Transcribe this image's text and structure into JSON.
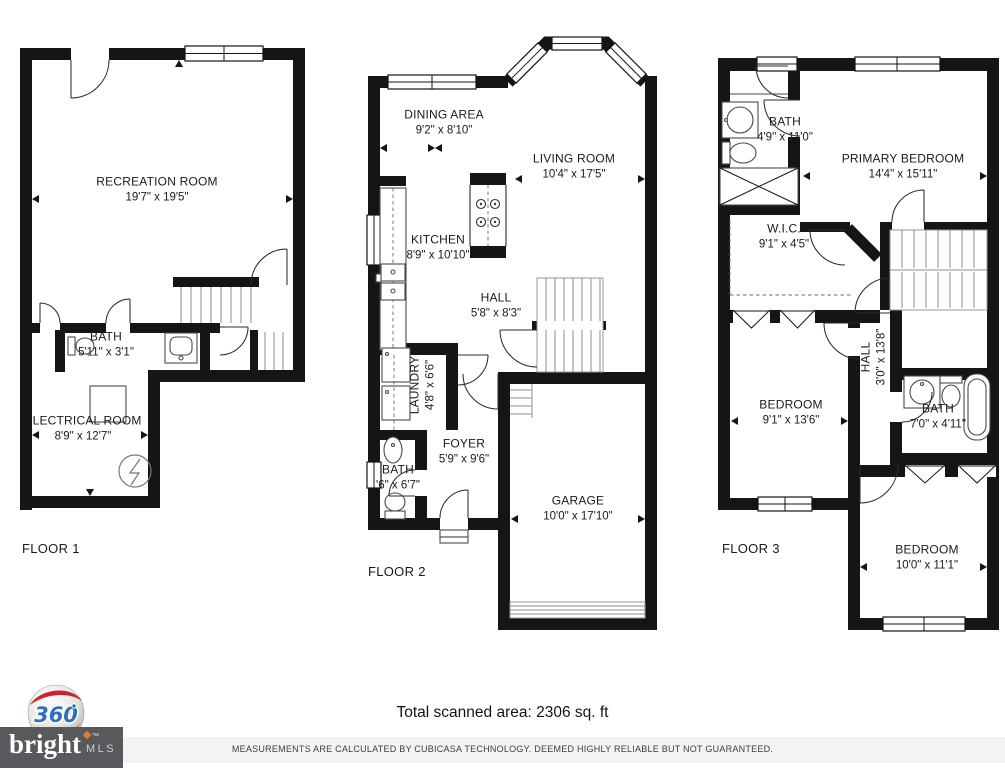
{
  "floors": [
    {
      "label": "FLOOR 1",
      "rooms": [
        {
          "name": "RECREATION ROOM",
          "dims": "19'7\" x 19'5\""
        },
        {
          "name": "BATH",
          "dims": "5'11\" x 3'1\""
        },
        {
          "name": "ELECTRICAL ROOM",
          "dims": "8'9\" x 12'7\""
        }
      ]
    },
    {
      "label": "FLOOR 2",
      "rooms": [
        {
          "name": "DINING AREA",
          "dims": "9'2\" x 8'10\""
        },
        {
          "name": "LIVING ROOM",
          "dims": "10'4\" x 17'5\""
        },
        {
          "name": "KITCHEN",
          "dims": "8'9\" x 10'10\""
        },
        {
          "name": "HALL",
          "dims": "5'8\" x 8'3\""
        },
        {
          "name": "LAUNDRY",
          "dims": "4'8\" x 6'6\""
        },
        {
          "name": "FOYER",
          "dims": "5'9\" x 9'6\""
        },
        {
          "name": "BATH",
          "dims": "'6\" x 6'7\""
        },
        {
          "name": "GARAGE",
          "dims": "10'0\" x 17'10\""
        }
      ]
    },
    {
      "label": "FLOOR 3",
      "rooms": [
        {
          "name": "BATH",
          "dims": "4'9\" x 11'0\""
        },
        {
          "name": "PRIMARY BEDROOM",
          "dims": "14'4\" x 15'11\""
        },
        {
          "name": "W.I.C.",
          "dims": "9'1\" x 4'5\""
        },
        {
          "name": "BEDROOM",
          "dims": "9'1\" x 13'6\""
        },
        {
          "name": "HALL",
          "dims": "3'0\" x 13'8\""
        },
        {
          "name": "BATH",
          "dims": "7'0\" x 4'11\""
        },
        {
          "name": "BEDROOM",
          "dims": "10'0\" x 11'1\""
        }
      ]
    }
  ],
  "footer": {
    "total_area": "Total scanned area: 2306 sq. ft",
    "disclaimer": "MEASUREMENTS ARE CALCULATED BY CUBICASA TECHNOLOGY. DEEMED HIGHLY RELIABLE BUT NOT GUARANTEED."
  },
  "logos": {
    "sphere_label": "360",
    "brand_name": "bright",
    "brand_tm": "™",
    "brand_suffix": "MLS"
  },
  "colors": {
    "wall": "#151515",
    "logo_red": "#c9252b",
    "logo_blue": "#2e6fb7",
    "brand_bg": "#58595c",
    "brand_orange": "#e87a28"
  }
}
